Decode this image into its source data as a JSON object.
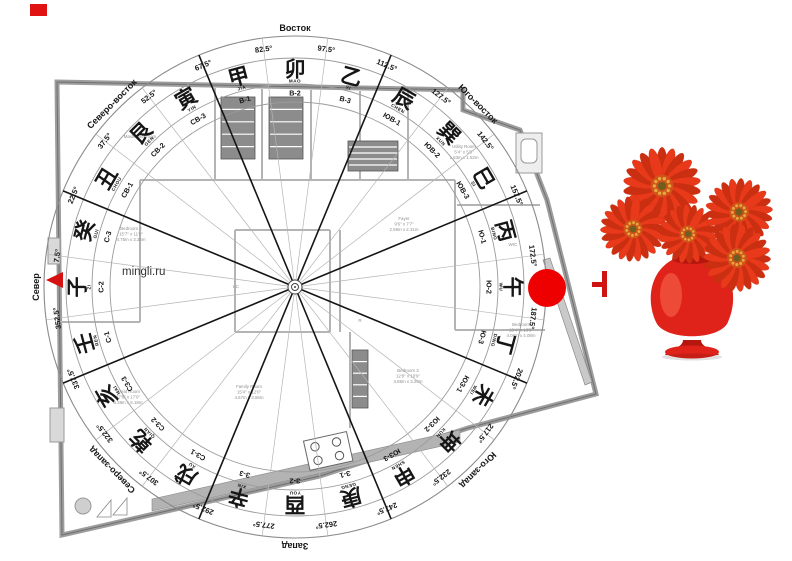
{
  "app": {
    "watermark": "mingli.ru"
  },
  "compass": {
    "center": {
      "x": 295,
      "y": 287
    },
    "radii": {
      "outer": 251,
      "ring2": 229,
      "ring3": 203,
      "ring4": 185,
      "deg_text": 240,
      "char": 217,
      "pinyin": 206,
      "code": 194,
      "dir_label": 259
    },
    "direction_labels": [
      {
        "label": "Север",
        "deg": 0
      },
      {
        "label": "Северо-восток",
        "deg": 45
      },
      {
        "label": "Восток",
        "deg": 90
      },
      {
        "label": "Юго-восток",
        "deg": 135
      },
      {
        "label": "Юго-запад",
        "deg": 225
      },
      {
        "label": "Запад",
        "deg": 270
      },
      {
        "label": "Северо-запад",
        "deg": 315
      }
    ],
    "degree_labels": [
      "7.5°",
      "22.5°",
      "37.5°",
      "52.5°",
      "67.5°",
      "82.5°",
      "97.5°",
      "112.5°",
      "127.5°",
      "142.5°",
      "157.5°",
      "172.5°",
      "187.5°",
      "202.5°",
      "217.5°",
      "232.5°",
      "247.5°",
      "262.5°",
      "277.5°",
      "292.5°",
      "307.5°",
      "322.5°",
      "337.5°",
      "352.5°"
    ],
    "sectors": [
      {
        "char": "子",
        "pinyin": "ZI",
        "code": "С-2",
        "deg": 0
      },
      {
        "char": "癸",
        "pinyin": "GUI",
        "code": "С-3",
        "deg": 15
      },
      {
        "char": "丑",
        "pinyin": "CHOU",
        "code": "СВ-1",
        "deg": 30
      },
      {
        "char": "艮",
        "pinyin": "GEN",
        "code": "СВ-2",
        "deg": 45
      },
      {
        "char": "寅",
        "pinyin": "YIN",
        "code": "СВ-3",
        "deg": 60
      },
      {
        "char": "甲",
        "pinyin": "JIA",
        "code": "В-1",
        "deg": 75
      },
      {
        "char": "卯",
        "pinyin": "MAO",
        "code": "В-2",
        "deg": 90
      },
      {
        "char": "乙",
        "pinyin": "YI",
        "code": "В-3",
        "deg": 105
      },
      {
        "char": "辰",
        "pinyin": "CHEN",
        "code": "ЮВ-1",
        "deg": 120
      },
      {
        "char": "巽",
        "pinyin": "XUN",
        "code": "ЮВ-2",
        "deg": 135
      },
      {
        "char": "巳",
        "pinyin": "SI",
        "code": "ЮВ-3",
        "deg": 150
      },
      {
        "char": "丙",
        "pinyin": "BING",
        "code": "Ю-1",
        "deg": 165
      },
      {
        "char": "午",
        "pinyin": "WU",
        "code": "Ю-2",
        "deg": 180
      },
      {
        "char": "丁",
        "pinyin": "DING",
        "code": "Ю-3",
        "deg": 195
      },
      {
        "char": "未",
        "pinyin": "WEI",
        "code": "ЮЗ-1",
        "deg": 210
      },
      {
        "char": "坤",
        "pinyin": "KUN",
        "code": "ЮЗ-2",
        "deg": 225
      },
      {
        "char": "申",
        "pinyin": "SHEN",
        "code": "ЮЗ-3",
        "deg": 240
      },
      {
        "char": "庚",
        "pinyin": "GENG",
        "code": "З-1",
        "deg": 255
      },
      {
        "char": "酉",
        "pinyin": "YOU",
        "code": "З-2",
        "deg": 270
      },
      {
        "char": "辛",
        "pinyin": "XIN",
        "code": "З-3",
        "deg": 285
      },
      {
        "char": "戌",
        "pinyin": "XU",
        "code": "СЗ-1",
        "deg": 300
      },
      {
        "char": "乾",
        "pinyin": "QIAN",
        "code": "СЗ-2",
        "deg": 315
      },
      {
        "char": "亥",
        "pinyin": "HAI",
        "code": "СЗ-3",
        "deg": 330
      },
      {
        "char": "壬",
        "pinyin": "REN",
        "code": "С-1",
        "deg": 345
      }
    ]
  },
  "floor_plan": {
    "rooms": [
      {
        "lines": [
          "Master Bedroom"
        ],
        "x": 140,
        "y": 138
      },
      {
        "lines": [
          "Bedroom 2",
          "15'7\" x 11'0\"",
          "4.75m x 3.35m"
        ],
        "x": 131,
        "y": 230
      },
      {
        "lines": [
          "Fayer",
          "9'6\" x 7'7\"",
          "2.59m x 2.31m"
        ],
        "x": 404,
        "y": 220
      },
      {
        "lines": [
          "Utility Room",
          "5'4\" x 5'0\"",
          "1.63m x 1.52m"
        ],
        "x": 464,
        "y": 148
      },
      {
        "lines": [
          "Family Room",
          "15'4\" x 12'0\"",
          "4.67m x 3.66m"
        ],
        "x": 249,
        "y": 388
      },
      {
        "lines": [
          "Great Room",
          "27'6\" x 17'0\"",
          "8.38m x 5.18m"
        ],
        "x": 128,
        "y": 393
      },
      {
        "lines": [
          "Bedroom 3",
          "12'8\" x 10'9\"",
          "3.86m x 3.28m"
        ],
        "x": 408,
        "y": 372
      },
      {
        "lines": [
          "Bedroom",
          "13'4\" x 13'5\"",
          "4.06m x 4.08m"
        ],
        "x": 521,
        "y": 326
      }
    ],
    "tags": [
      {
        "text": "WIC",
        "x": 239,
        "y": 117
      },
      {
        "text": "WIC",
        "x": 288,
        "y": 117
      },
      {
        "text": "WIC",
        "x": 513,
        "y": 246
      },
      {
        "text": "LC",
        "x": 236,
        "y": 288
      },
      {
        "text": "R",
        "x": 360,
        "y": 322
      }
    ]
  },
  "markers": {
    "square": {
      "color": "#e11212"
    },
    "north_arrow": {
      "color": "#d51111"
    },
    "circle": {
      "color": "#ee0000"
    },
    "plus": {
      "color": "#cf1313"
    }
  },
  "vase": {
    "colors": {
      "petal": "#e8391b",
      "petal_dark": "#c92f10",
      "disc": "#d1521a",
      "speckle": "#e2aa3c",
      "core": "#6f5e1e",
      "body": "#e0231a",
      "body_dark": "#b5170f",
      "highlight": "#ff7a5e",
      "leaf": "#5d8a33"
    },
    "flowers": [
      {
        "cx": 662,
        "cy": 186,
        "r": 38
      },
      {
        "cx": 633,
        "cy": 229,
        "r": 32
      },
      {
        "cx": 688,
        "cy": 234,
        "r": 29
      },
      {
        "cx": 739,
        "cy": 212,
        "r": 33
      },
      {
        "cx": 737,
        "cy": 258,
        "r": 33
      }
    ]
  }
}
